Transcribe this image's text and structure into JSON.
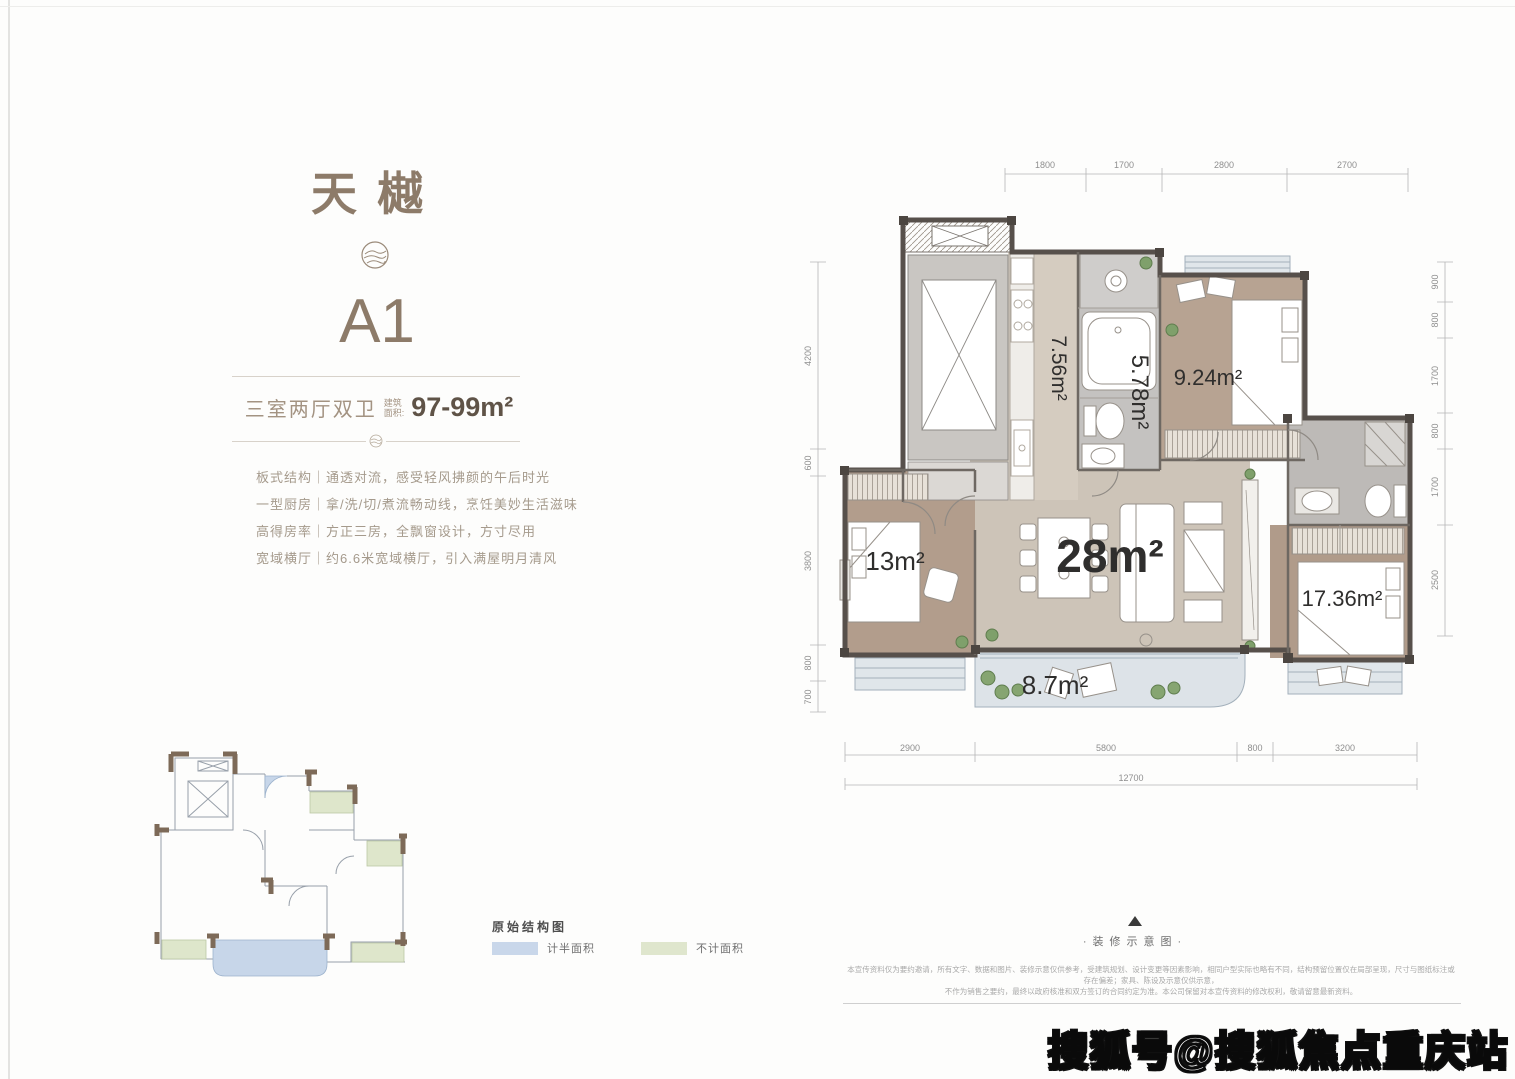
{
  "brand": {
    "title": "天樾",
    "unit": "A1"
  },
  "spec": {
    "layout": "三室两厅双卫",
    "area_label_line1": "建筑",
    "area_label_line2": "面积:",
    "area_value": "97-99m²"
  },
  "features": [
    "板式结构｜通透对流，感受轻风拂颜的午后时光",
    "一型厨房｜拿/洗/切/煮流畅动线，烹饪美妙生活滋味",
    "高得房率｜方正三房，全飘窗设计，方寸尽用",
    "宽域横厅｜约6.6米宽域横厅，引入满屋明月清风"
  ],
  "structure_diagram": {
    "title": "原始结构图",
    "legend": [
      {
        "label": "计半面积",
        "color": "#c9d7ea"
      },
      {
        "label": "不计面积",
        "color": "#dfe6cd"
      }
    ]
  },
  "floor_plan": {
    "rooms": {
      "kitchen": "7.56m²",
      "bath": "5.78m²",
      "bedroom_top": "9.24m²",
      "living": "28m²",
      "bedroom_left": "13m²",
      "bedroom_master": "17.36m²",
      "balcony": "8.7m²"
    },
    "dims_top": [
      "1800",
      "1700",
      "2800",
      "2700"
    ],
    "dims_right": [
      "900",
      "800",
      "1700",
      "800",
      "1700",
      "2500"
    ],
    "dims_left": [
      "4200",
      "600",
      "3800",
      "800",
      "700"
    ],
    "dims_bottom": [
      "2900",
      "5800",
      "800",
      "3200"
    ],
    "dim_total": "12700"
  },
  "footer": {
    "schematic_label": "·装修示意图·",
    "disclaimer_line1": "本宣传资料仅为要约邀请，所有文字、数据和图片、装修示意仅供参考，受建筑规划、设计变更等因素影响，相同户型实际也略有不同，结构预留位置仅在局部呈现，尺寸与图纸标注或存在偏差；家具、陈设及示意仅供示意，",
    "disclaimer_line2": "不作为销售之要约，最终以政府核准和双方签订的合同约定为准。本公司保留对本宣传资料的修改权利，敬请留意最新资料。"
  },
  "watermark": "搜狐号@搜狐焦点重庆站"
}
